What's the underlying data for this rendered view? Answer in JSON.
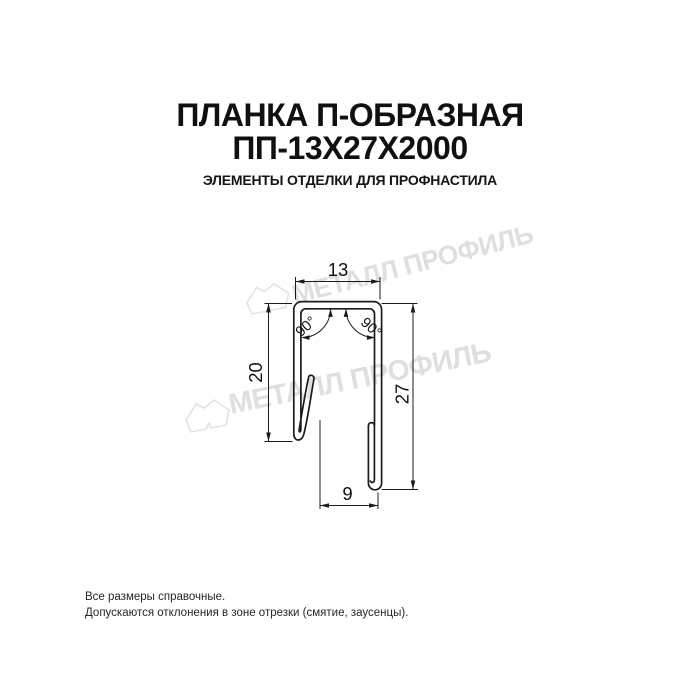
{
  "header": {
    "title_line1": "ПЛАНКА П-ОБРАЗНАЯ",
    "title_line2": "ПП-13Х27Х2000",
    "subtitle": "ЭЛЕМЕНТЫ ОТДЕЛКИ ДЛЯ ПРОФНАСТИЛА"
  },
  "drawing": {
    "dim_top_width": "13",
    "dim_left_height": "20",
    "dim_right_height": "27",
    "dim_bottom_width": "9",
    "angle_left": "90°",
    "angle_right": "90°",
    "line_color": "#1b1b1b"
  },
  "watermark": {
    "brand_text": "МЕТАЛЛ ПРОФИЛЬ",
    "color": "#dfdfdf"
  },
  "footer": {
    "line1": "Все размеры справочные.",
    "line2": "Допускаются отклонения в зоне отрезки (смятие, заусенцы)."
  }
}
